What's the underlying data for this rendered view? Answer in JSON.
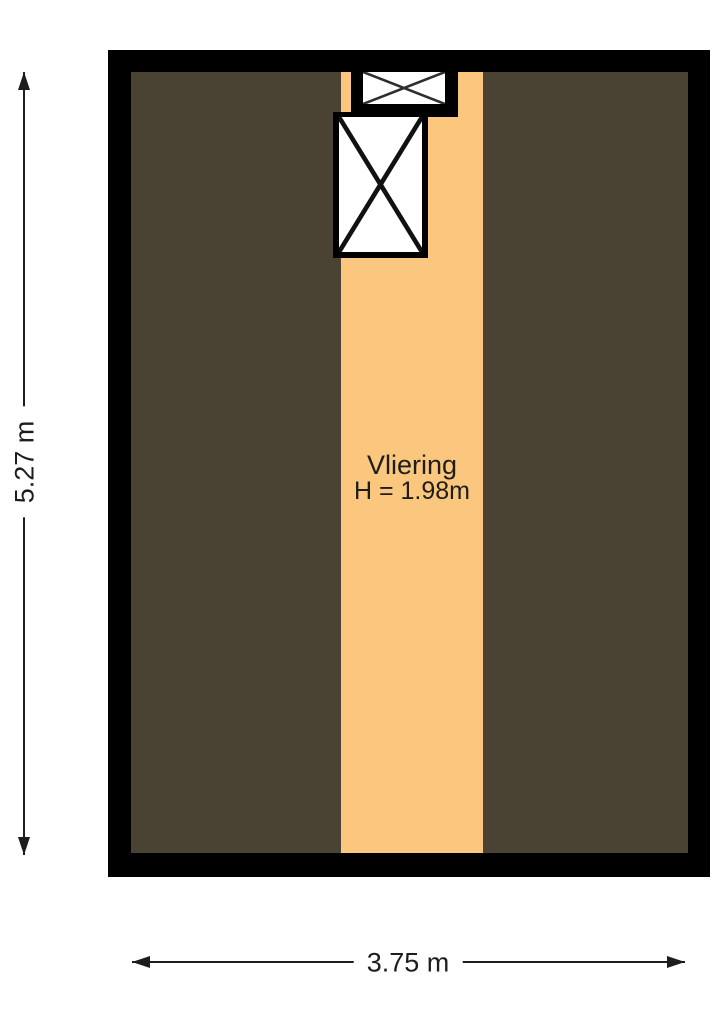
{
  "floorplan": {
    "room": {
      "name": "Vliering",
      "height_label": "H = 1.98m"
    },
    "dimensions": {
      "vertical_label": "5.27 m",
      "horizontal_label": "3.75 m"
    },
    "colors": {
      "wall": "#000000",
      "sloped_area": "#4A4333",
      "floor": "#FBC67D",
      "line": "#1D1D1B",
      "text": "#1D1D1B",
      "hatch_cross": "#2E2E2E",
      "stair_cross": "#111111"
    },
    "symbols": {
      "loft_hatch": "crossed-box",
      "stair_opening": "crossed-box"
    }
  }
}
